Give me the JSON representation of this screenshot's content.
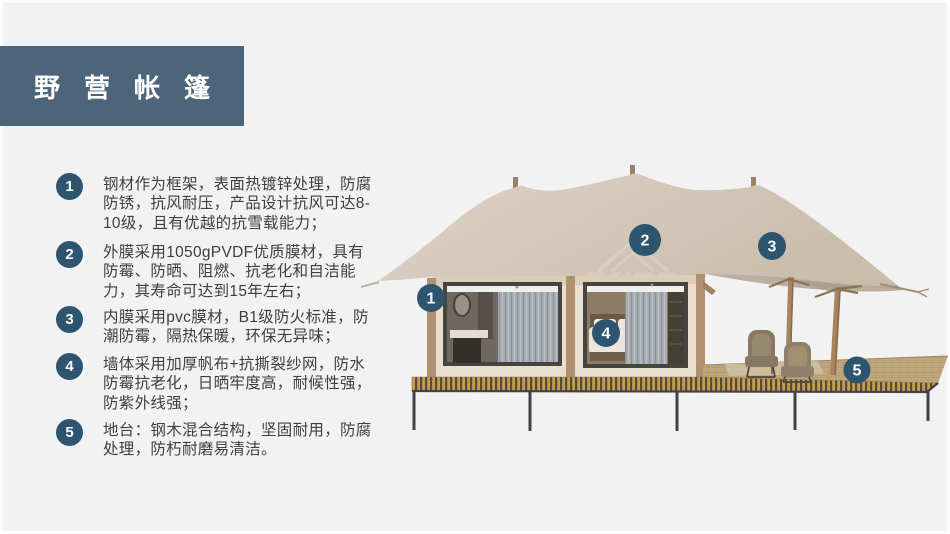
{
  "title": {
    "text": "野营帐篷"
  },
  "features": [
    {
      "num": "1",
      "text": "钢材作为框架，表面热镀锌处理，防腐防锈，抗风耐压，产品设计抗风可达8-10级，且有优越的抗雪载能力；"
    },
    {
      "num": "2",
      "text": "外膜采用1050gPVDF优质膜材，具有防霉、防晒、阻燃、抗老化和自洁能力，其寿命可达到15年左右；"
    },
    {
      "num": "3",
      "text": "内膜采用pvc膜材，B1级防火标准，防潮防霉，隔热保暖，环保无异味；"
    },
    {
      "num": "4",
      "text": "墙体采用加厚帆布+抗撕裂纱网，防水防霉抗老化，日晒牢度高，耐候性强，防紫外线强；"
    },
    {
      "num": "5",
      "text": "地台：钢木混合结构，坚固耐用，防腐处理，防朽耐磨易清洁。"
    }
  ],
  "diagram": {
    "markers": [
      "1",
      "2",
      "3",
      "4",
      "5"
    ],
    "watermark": {
      "text": "雪利篷居"
    }
  },
  "colors": {
    "background": "#f2f2f3",
    "title_bar": "#4d657a",
    "marker_circle": "#2e5570",
    "body_text": "#3f3f3f",
    "tent_canvas": "#d5c9ba",
    "tent_wall": "#e9dfd0",
    "deck_wood": "#c0a87d",
    "deck_band_gold": "#c49e4f"
  }
}
